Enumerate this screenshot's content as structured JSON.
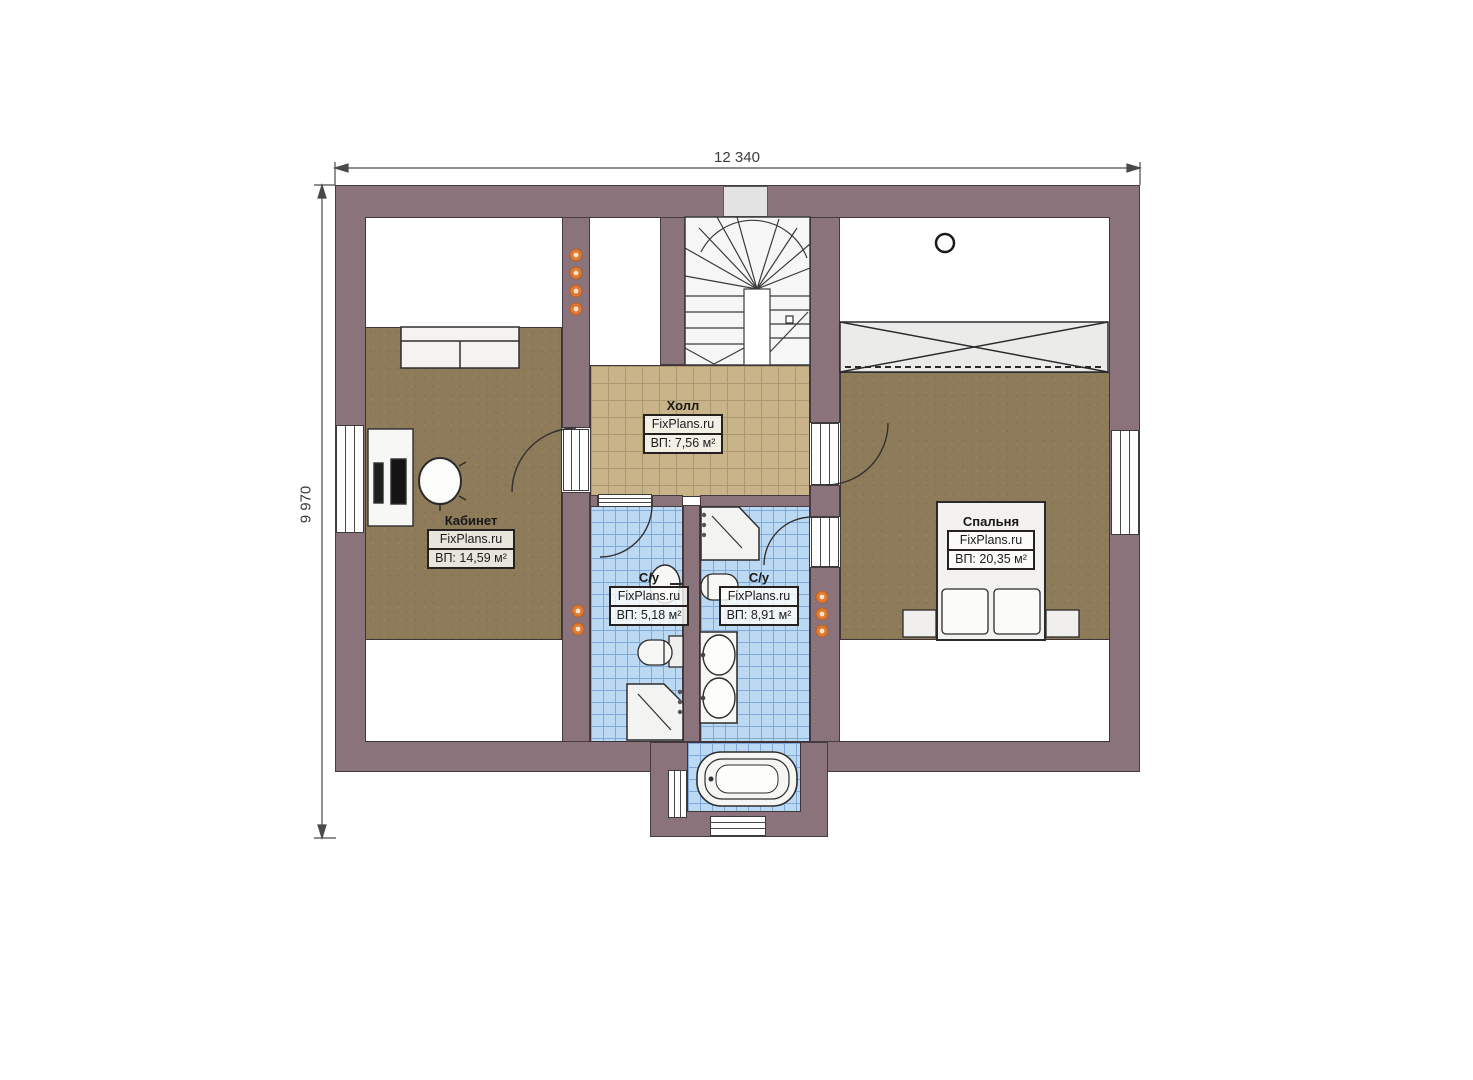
{
  "plan": {
    "type": "floor-plan",
    "floor": "attic-level"
  },
  "dimensions": {
    "width": "12 340",
    "height": "9 970"
  },
  "rooms": {
    "hall": {
      "name": "Холл",
      "brand": "FixPlans.ru",
      "area": "ВП: 7,56 м²"
    },
    "office": {
      "name": "Кабинет",
      "brand": "FixPlans.ru",
      "area": "ВП: 14,59 м²"
    },
    "bedroom": {
      "name": "Спальня",
      "brand": "FixPlans.ru",
      "area": "ВП: 20,35 м²"
    },
    "bath_small": {
      "name": "С/у",
      "brand": "FixPlans.ru",
      "area": "ВП: 5,18 м²"
    },
    "bath_large": {
      "name": "С/у",
      "brand": "FixPlans.ru",
      "area": "ВП: 8,91 м²"
    }
  },
  "colors": {
    "wall": "#8a737b",
    "room_floor": "#8d7b59",
    "hall_floor": "#c9b489",
    "bath_floor": "#bcd9f4",
    "wall_light": "#df7a33"
  }
}
